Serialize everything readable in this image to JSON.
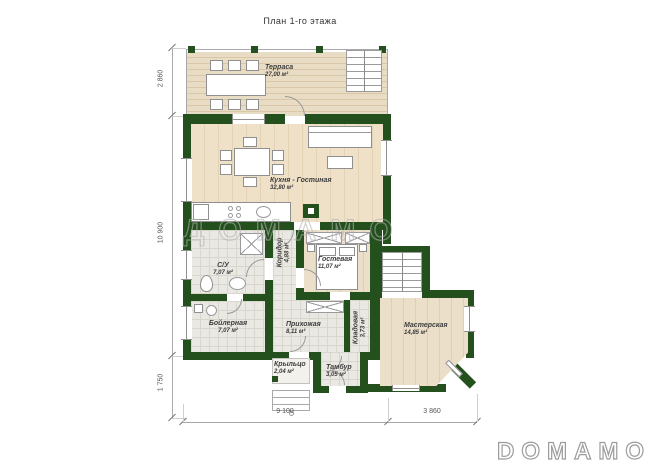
{
  "title": "План 1-го этажа",
  "watermark": "ДОМАМО",
  "logo": "DOMAMO",
  "colors": {
    "wall_green": "#24501e",
    "deck_wood": "#e9dcc4",
    "floor_wood": "#efe1c8"
  },
  "rooms": {
    "terrace": {
      "name": "Терраса",
      "area": "27,00 м²"
    },
    "kitchen_living": {
      "name": "Кухня - Гостиная",
      "area": "32,80 м²"
    },
    "bathroom": {
      "name": "С/У",
      "area": "7,07 м²"
    },
    "boiler": {
      "name": "Бойлерная",
      "area": "7,07 м²"
    },
    "corridor": {
      "name": "Коридор",
      "area": "4,88 м²"
    },
    "guest": {
      "name": "Гостевая",
      "area": "11,07 м²"
    },
    "hallway": {
      "name": "Прихожая",
      "area": "8,11 м²"
    },
    "storage": {
      "name": "Кладовая",
      "area": "3,73 м²"
    },
    "workshop": {
      "name": "Мастерская",
      "area": "14,85 м²"
    },
    "porch": {
      "name": "Крыльцо",
      "area": "2,04 м²"
    },
    "vestibule": {
      "name": "Тамбур",
      "area": "3,05 м²"
    }
  },
  "dimensions": {
    "left": [
      "2 860",
      "10 900",
      "1 750"
    ],
    "bottom": [
      "9 100",
      "3 860"
    ]
  }
}
